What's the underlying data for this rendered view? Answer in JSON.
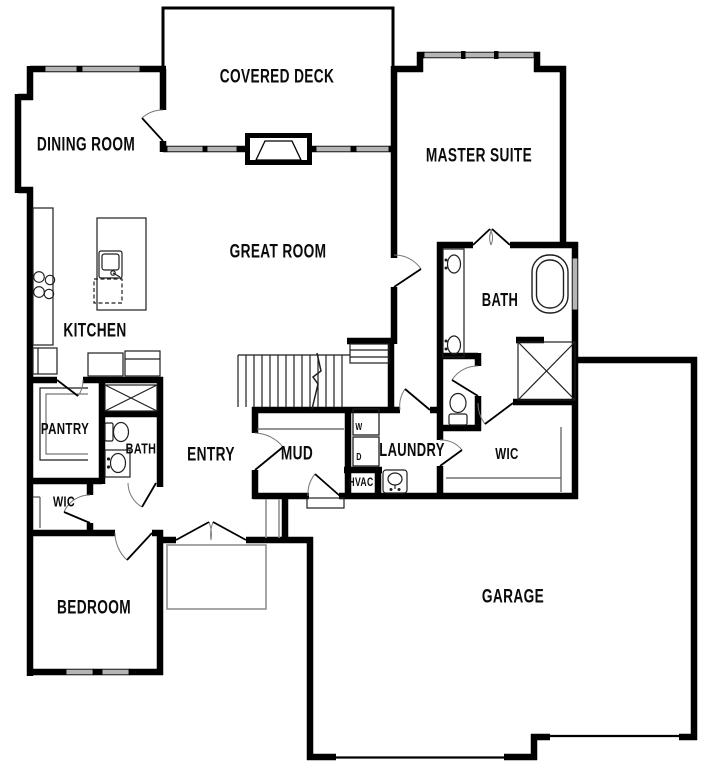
{
  "plan_type": "single-story-house-floor-plan",
  "colors": {
    "background": "#ffffff",
    "wall": "#000000",
    "window_fill": "#b5b5b5",
    "fixture_line": "#1f1f1f",
    "shelf_line": "#555555",
    "door_arc": "#777777",
    "porch_outline": "#8f8f8f"
  },
  "rooms": [
    {
      "id": "covered-deck",
      "label": "COVERED DECK"
    },
    {
      "id": "dining-room",
      "label": "DINING ROOM"
    },
    {
      "id": "master-suite",
      "label": "MASTER SUITE"
    },
    {
      "id": "great-room",
      "label": "GREAT ROOM"
    },
    {
      "id": "kitchen",
      "label": "KITCHEN"
    },
    {
      "id": "pantry",
      "label": "PANTRY"
    },
    {
      "id": "bath-main",
      "label": "BATH"
    },
    {
      "id": "entry",
      "label": "ENTRY"
    },
    {
      "id": "wic-front",
      "label": "WIC"
    },
    {
      "id": "mud",
      "label": "MUD"
    },
    {
      "id": "laundry",
      "label": "LAUNDRY"
    },
    {
      "id": "hvac",
      "label": "HVAC"
    },
    {
      "id": "bath-master",
      "label": "BATH"
    },
    {
      "id": "wic-master",
      "label": "WIC"
    },
    {
      "id": "bedroom",
      "label": "BEDROOM"
    },
    {
      "id": "garage",
      "label": "GARAGE"
    },
    {
      "id": "washer",
      "label": "W"
    },
    {
      "id": "dryer",
      "label": "D"
    }
  ],
  "fixtures": [
    "cooktop-icon",
    "refrigerator-icon",
    "island-sink-icon",
    "dishwasher-icon",
    "pantry-shelves",
    "toilet-icon",
    "vanity-sink-icon",
    "linen-shower-x",
    "stairs-icon",
    "mud-bench",
    "washer-icon",
    "dryer-icon",
    "laundry-sink-icon",
    "double-vanity-icon",
    "freestanding-tub-icon",
    "shower-x-icon",
    "closet-shelves",
    "fireplace-icon",
    "front-porch",
    "covered-deck-outline"
  ]
}
